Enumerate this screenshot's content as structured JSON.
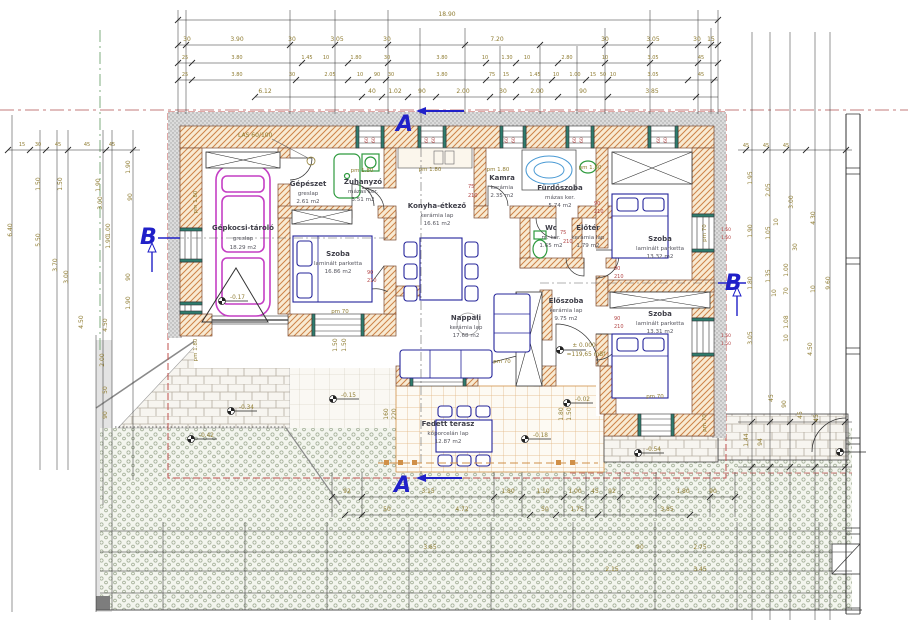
{
  "drawing_labels": {
    "lintel": "LAS 60/100",
    "datum_top": "± 0.000",
    "datum_bottom": "=119,65 mBf",
    "pm180": "pm 1.80",
    "pm70": "pm 70",
    "sill": "60",
    "sill150": "1.50",
    "door_w90": "90",
    "door_h210": "210",
    "door_w75": "75",
    "section_a": "A",
    "section_b": "B"
  },
  "rooms": [
    {
      "name": "Gépkocsi-tároló",
      "floor": "greslap",
      "area": "18.29 m2"
    },
    {
      "name": "Gépészet",
      "floor": "greslap",
      "area": "2.61 m2"
    },
    {
      "name": "Zuhanyzó",
      "floor": "mázas ker.",
      "area": "3.51 m2"
    },
    {
      "name": "Szoba",
      "floor": "laminált parketta",
      "area": "16.86 m2"
    },
    {
      "name": "Konyha-étkező",
      "floor": "kerámia lap",
      "area": "16.61 m2"
    },
    {
      "name": "Kamra",
      "floor": "kerámia",
      "area": "2.35 m2"
    },
    {
      "name": "Fürdőszoba",
      "floor": "mázas ker.",
      "area": "5.74 m2"
    },
    {
      "name": "Wc",
      "floor": "m. ker.",
      "area": "1.65 m2"
    },
    {
      "name": "Előtér",
      "floor": "kerámia lap",
      "area": "1.79 m2"
    },
    {
      "name": "Szoba",
      "floor": "laminált parketta",
      "area": "13.32 m2"
    },
    {
      "name": "Előszoba",
      "floor": "kerámia lap",
      "area": "9.75 m2"
    },
    {
      "name": "Szoba",
      "floor": "laminált parketta",
      "area": "13.31 m2"
    },
    {
      "name": "Nappali",
      "floor": "kerámia lap",
      "area": "17.68 m2"
    },
    {
      "name": "Fedett terasz",
      "floor": "kőporcelán lap",
      "area": "12.87 m2"
    }
  ],
  "levels": [
    "-0.17",
    "-0.34",
    "-0.42",
    "-0.15",
    "-0.02",
    "-0.18",
    "-0.54"
  ],
  "dims": {
    "overall": "18.90",
    "top2": [
      "30",
      "3.90",
      "30",
      "3.05",
      "30",
      "7.20",
      "30",
      "3.05",
      "30",
      "15"
    ],
    "top3": [
      "25",
      "3.80",
      "1.45",
      "10",
      "1.80",
      "30",
      "3.80",
      "10",
      "1.30",
      "10",
      "2.80",
      "10",
      "3.05",
      "45"
    ],
    "top4": [
      "25",
      "3.80",
      "30",
      "2.05",
      "10",
      "90",
      "30",
      "3.80",
      "75",
      "15",
      "1.45",
      "10",
      "1.00",
      "15",
      "50",
      "10",
      "3.05",
      "45"
    ],
    "top5": [
      "6.12",
      "40",
      "1.02",
      "90",
      "2.00",
      "30",
      "2.00",
      "90",
      "3.85"
    ],
    "bottom1": [
      "92",
      "3.15",
      "1.80",
      "1.10",
      "1.00",
      "45",
      "92",
      "1.80",
      "90"
    ],
    "bottom2": [
      "50",
      "4.72",
      "50",
      "1.75",
      "3.85"
    ],
    "gravel1": [
      "3.65",
      "90",
      "2.75"
    ],
    "gravel2": [
      "2.15",
      "3.45"
    ],
    "left_small": [
      "15",
      "30",
      "45",
      "45",
      "45"
    ],
    "right_small": [
      "45",
      "45",
      "45"
    ],
    "left_col": [
      "6.40",
      "5.50",
      "3.70",
      "3.00",
      "1.50",
      "1.50",
      "1.90",
      "1.90",
      "3.00",
      "1.00",
      "1.90",
      "90",
      "90",
      "1.90",
      "4.50",
      "4.50",
      "2.00",
      "50",
      "90"
    ],
    "right_col": [
      "1.95",
      "2.05",
      "3.00",
      "4.30",
      "9.60",
      "1.90",
      "1.05",
      "10",
      "1.35",
      "1.00",
      "30",
      "70",
      "10",
      "1.80",
      "10",
      "1.08",
      "3.05",
      "10",
      "4.50"
    ],
    "right_lower": [
      "45",
      "90",
      "45",
      "45",
      "1.44",
      "94"
    ],
    "terrace_col": [
      "160",
      "220",
      "1.80",
      "1.50",
      "1.50",
      "1.50"
    ]
  },
  "colors": {
    "wall_hatch": "#cd8348",
    "dimension_text": "#8f7c32",
    "annotation_red": "#b34545",
    "furniture_blue": "#24249a",
    "sanitary_green": "#2e9a3e",
    "car_magenta": "#c43fc4",
    "section_blue": "#2020c8",
    "roof_dash_red": "#c0504d",
    "boundary_green": "#7fae7f"
  }
}
